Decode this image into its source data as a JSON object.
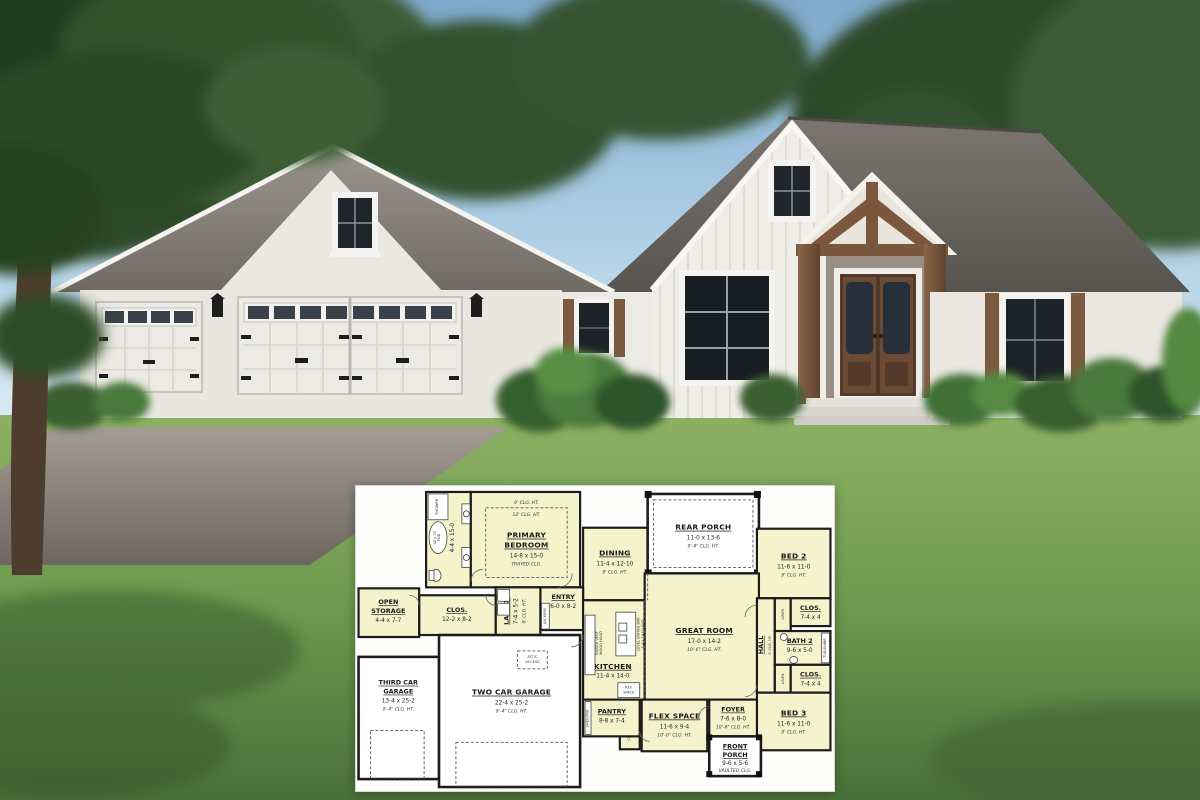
{
  "palette": {
    "sky_top": "#7fa9cc",
    "sky_bottom": "#e8f2f8",
    "cloud": "#ffffff",
    "tree_dark": "#243f22",
    "tree_mid": "#35552f",
    "roof_shingle": "#807b73",
    "wall_white": "#e8e6df",
    "wood_trim": "#7a573d",
    "lawn_green": "#6d9a4e",
    "driveway_gray": "#8d867d",
    "plan_background": "#fdfdfb",
    "plan_room_fill": "#f5f3cb",
    "plan_wall": "#1c1c1c"
  },
  "floor_plan": {
    "rooms": {
      "primary_bedroom": {
        "name_lines": [
          "PRIMARY",
          "BEDROOM"
        ],
        "dims": "14-8 x 15-0",
        "note": "TRAYED CLG.",
        "ceiling_outer": "9' CLG. HT.",
        "ceiling_tray": "12' CLG. HT."
      },
      "bath": {
        "name": "BATH",
        "dims": "4-4 x 15-0"
      },
      "dining": {
        "name": "DINING",
        "dims": "11-4 x 12-10",
        "note": "9' CLG. HT."
      },
      "rear_porch": {
        "name": "REAR PORCH",
        "dims": "11-0 x 13-6",
        "note": "9'-4\" CLG. HT."
      },
      "bed2": {
        "name": "BED 2",
        "dims": "11-6 x 11-0",
        "note": "9' CLG. HT."
      },
      "clos_bed2": {
        "name": "CLOS.",
        "dims": "7-4 x 4"
      },
      "linen1": {
        "name": "LINEN"
      },
      "hall": {
        "name": "HALL",
        "note": "9' CLG. HT."
      },
      "bath2": {
        "name": "BATH 2",
        "dims": "9-6 x 5-0"
      },
      "linen2": {
        "name": "LINEN"
      },
      "clos_bed3": {
        "name": "CLOS.",
        "dims": "7-4 x 4"
      },
      "bed3": {
        "name": "BED 3",
        "dims": "11-6 x 11-0",
        "note": "9' CLG. HT."
      },
      "great_room": {
        "name": "GREAT ROOM",
        "dims": "17-0 x 14-2",
        "note": "10'-6\" CLG. HT."
      },
      "kitchen": {
        "name": "KITCHEN",
        "dims": "11-4 x 14-0"
      },
      "entry": {
        "name": "ENTRY",
        "dims": "6-0 x 8-2"
      },
      "laundry": {
        "name": "LAUND.",
        "dims": "7-4 x 5-2",
        "note": "9' CLG. HT."
      },
      "closet_primary": {
        "name": "CLOS.",
        "dims": "12-2 x 8-2"
      },
      "open_storage": {
        "name_lines": [
          "OPEN",
          "STORAGE"
        ],
        "dims": "4-4 x 7-7"
      },
      "third_car_garage": {
        "name_lines": [
          "THIRD CAR",
          "GARAGE"
        ],
        "dims": "13-4 x 25-2",
        "note": "9'-4\" CLG. HT."
      },
      "two_car_garage": {
        "name": "TWO CAR GARAGE",
        "dims": "22-4 x 25-2",
        "note": "9'-4\" CLG. HT."
      },
      "pantry": {
        "name": "PANTRY",
        "dims": "8-8 x 7-4"
      },
      "clos_flex": {
        "name": "CLOS."
      },
      "flex_space": {
        "name": "FLEX SPACE",
        "dims": "11-6 x 9-4",
        "note": "10'-6\" CLG. HT."
      },
      "foyer": {
        "name": "FOYER",
        "dims": "7-6 x 8-0",
        "note": "10'-6\" CLG. HT."
      },
      "front_porch": {
        "name_lines": [
          "FRONT",
          "PORCH"
        ],
        "dims": "9-6 x 5-6",
        "note": "VAULTED CLG."
      }
    },
    "fixtures": {
      "attic_access_lines": [
        "ATTIC",
        "ACCESS"
      ],
      "ref_space_lines": [
        "REF.",
        "SPACE"
      ],
      "shelving": "SHELVING",
      "lockers": "LOCKERS",
      "hanging": "HANGING",
      "eating_bar": "LEVEL EATING BAR",
      "island": "3-4 x 14 ISLAND",
      "hood_lines": [
        "RAISED VENT",
        "WOOD HOOD"
      ],
      "tub_lines": [
        "42 x 72",
        "TUB"
      ],
      "shower": "SHOWER",
      "tub_shwr": "TUB/SHWR"
    }
  }
}
